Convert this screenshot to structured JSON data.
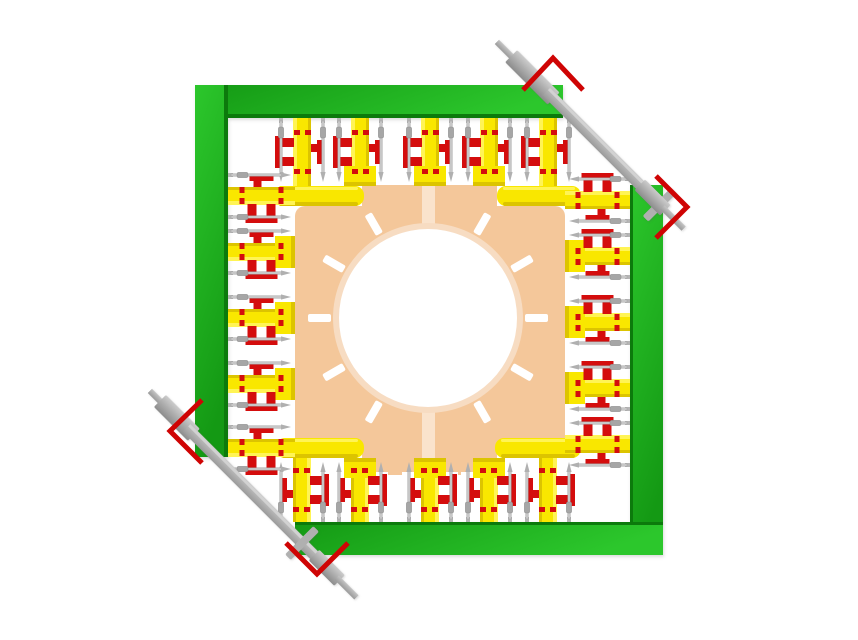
{
  "colors": {
    "background": "#ffffff",
    "green_light": "#2cc72c",
    "green_main": "#1cb01c",
    "green_deep": "#149914",
    "green_edge": "#0c7a0c",
    "yellow": "#f9e700",
    "yellow_light": "#fff455",
    "yellow_dark": "#dcc400",
    "red": "#d40d0d",
    "chevron_red": "#cf0404",
    "tan_plate": "#f4c79a",
    "ring_pale": "#f7dcc2",
    "stripe_pale": "#fae3cc",
    "shaft_gray": "#a9a9a9",
    "shaft_light": "#cccccc",
    "shaft_dark": "#8c8c8c",
    "pin_gray": "#c9c9c9",
    "pin_outline": "#9f9f9f",
    "pin_bead": "#a6a6a6",
    "white": "#ffffff"
  },
  "frames": [
    {
      "name": "frame-top-bar",
      "x": 195,
      "y": 85,
      "w": 368,
      "h": 33,
      "grad": "h",
      "edge": "bottom"
    },
    {
      "name": "frame-left-bar",
      "x": 195,
      "y": 85,
      "w": 33,
      "h": 372,
      "grad": "v",
      "edge": "right"
    },
    {
      "name": "frame-right-bar",
      "x": 630,
      "y": 185,
      "w": 33,
      "h": 370,
      "grad": "v",
      "edge": "left"
    },
    {
      "name": "frame-bottom-bar",
      "x": 295,
      "y": 522,
      "w": 368,
      "h": 33,
      "grad": "h",
      "edge": "top"
    }
  ],
  "plate": {
    "main": {
      "x": 295,
      "y": 206,
      "w": 270,
      "h": 246,
      "rx": 10
    },
    "tab_top": {
      "x": 362,
      "y": 185,
      "w": 135,
      "h": 24
    },
    "tab_bottom": {
      "x": 362,
      "y": 449,
      "w": 135,
      "h": 26
    },
    "stripe": {
      "x": 422,
      "y": 186,
      "w": 13,
      "h": 289
    }
  },
  "dial": {
    "cx": 428,
    "cy": 318,
    "r_ring": 95,
    "r_disc": 89,
    "tick_inner": 97,
    "tick_len": 23,
    "tick_w": 8,
    "tick_angles": [
      0,
      30,
      60,
      120,
      150,
      180,
      210,
      240,
      300,
      330
    ]
  },
  "corner_bars": [
    {
      "name": "corner-bar-top-left",
      "x": 270,
      "y": 186,
      "w": 94,
      "h": 20
    },
    {
      "name": "corner-bar-top-right",
      "x": 497,
      "y": 186,
      "w": 84,
      "h": 20
    },
    {
      "name": "corner-bar-bottom-left",
      "x": 276,
      "y": 438,
      "w": 88,
      "h": 20
    },
    {
      "name": "corner-bar-bottom-right",
      "x": 495,
      "y": 438,
      "w": 86,
      "h": 20
    }
  ],
  "unit_sides": {
    "top": {
      "angle": 0,
      "edge": 118,
      "length": 68,
      "centers": [
        302,
        360,
        430,
        489,
        548
      ],
      "feet": [
        false,
        true,
        true,
        true,
        false
      ]
    },
    "bottom": {
      "angle": 180,
      "edge": 522,
      "length": 64,
      "centers": [
        302,
        360,
        430,
        489,
        548
      ],
      "feet": [
        false,
        true,
        true,
        true,
        false
      ]
    },
    "left": {
      "angle": -90,
      "edge": 228,
      "length": 67,
      "centers": [
        196,
        252,
        318,
        384,
        448
      ],
      "feet": [
        false,
        true,
        true,
        true,
        false
      ]
    },
    "right": {
      "angle": 90,
      "edge": 630,
      "length": 65,
      "centers": [
        200,
        256,
        322,
        388,
        444
      ],
      "feet": [
        false,
        true,
        true,
        true,
        false
      ]
    }
  },
  "unit_design": {
    "bar_half_w": 9,
    "foot_half_w": 16,
    "foot_len": 20,
    "pin_offset": 21,
    "clamp": {
      "back": [
        -28,
        -18,
        56,
        36
      ],
      "flange_left": [
        -27,
        -16,
        6,
        32
      ],
      "rung1": [
        -22,
        -14,
        14,
        9
      ],
      "rung2": [
        -22,
        5,
        14,
        9
      ],
      "rung_right": [
        9,
        -8,
        9,
        8
      ],
      "flange_right": [
        15,
        -12,
        5,
        24
      ],
      "notches": [
        [
          -8,
          -22,
          6,
          5
        ],
        [
          3,
          -22,
          6,
          5
        ],
        [
          -8,
          17,
          6,
          5
        ],
        [
          3,
          17,
          6,
          5
        ]
      ]
    }
  },
  "shafts": [
    {
      "name": "shaft-top-right",
      "x": 497,
      "y": 42,
      "angle": 45,
      "tip1": [
        0,
        28
      ],
      "sleeve1": [
        20,
        80
      ],
      "body": [
        70,
        212
      ],
      "sleeve2": [
        202,
        238
      ],
      "tip2": [
        234,
        264
      ],
      "crossbar_at": 230
    },
    {
      "name": "shaft-bottom-left",
      "x": 150,
      "y": 391,
      "angle": 45,
      "tip1": [
        0,
        26
      ],
      "sleeve1": [
        14,
        62
      ],
      "body": [
        52,
        244
      ],
      "sleeve2": [
        232,
        268
      ],
      "tip2": [
        264,
        292
      ],
      "crossbar_at": 215
    }
  ],
  "chevrons": [
    {
      "name": "chevron-top",
      "points": [
        [
          523,
          90
        ],
        [
          553,
          58
        ],
        [
          583,
          90
        ]
      ]
    },
    {
      "name": "chevron-right",
      "points": [
        [
          656,
          176
        ],
        [
          687,
          207
        ],
        [
          656,
          238
        ]
      ]
    },
    {
      "name": "chevron-left",
      "points": [
        [
          202,
          400
        ],
        [
          170,
          431
        ],
        [
          202,
          463
        ]
      ]
    },
    {
      "name": "chevron-bottom",
      "points": [
        [
          286,
          543
        ],
        [
          317,
          574
        ],
        [
          348,
          543
        ]
      ]
    }
  ]
}
